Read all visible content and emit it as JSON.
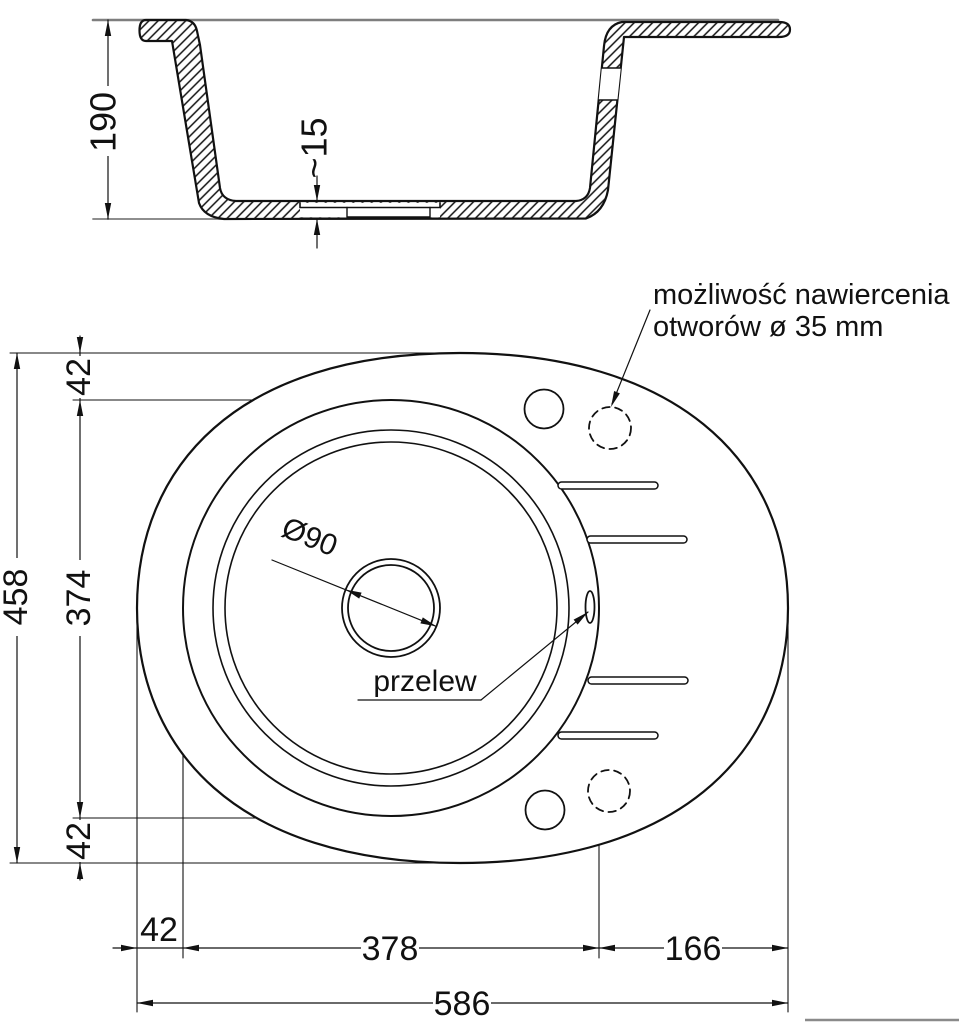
{
  "page": {
    "background": "#ffffff"
  },
  "colors": {
    "ink": "#111111",
    "counter_line": "#7e7e7e"
  },
  "section_view": {
    "depth_label": "190",
    "floor_thickness_label": "~15"
  },
  "top_view": {
    "drill_note_line1": "możliwość nawiercenia",
    "drill_note_line2": "otworów ø 35 mm",
    "drain_label": "Ø90",
    "overflow_label": "przelew",
    "left_overall": "458",
    "left_top": "42",
    "left_basin": "374",
    "left_bottom": "42",
    "bottom_left": "42",
    "bottom_basin": "378",
    "bottom_right": "166",
    "bottom_overall": "586"
  }
}
